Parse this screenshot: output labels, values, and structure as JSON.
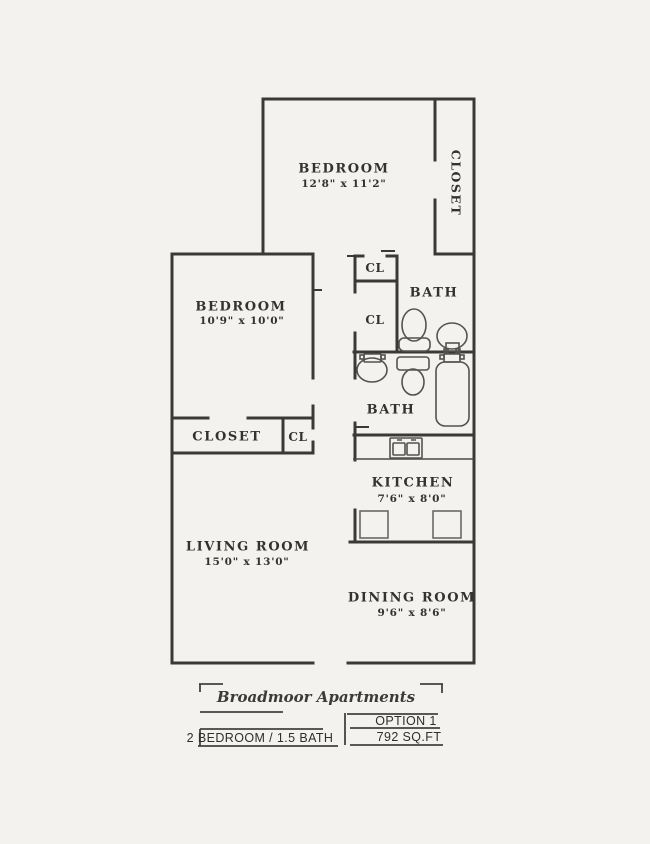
{
  "plan": {
    "bedroom_top": {
      "label": "BEDROOM",
      "dims": "12'8\" x 11'2\"",
      "closet": "CLOSET"
    },
    "bedroom_left": {
      "label": "BEDROOM",
      "dims": "10'9\" x 10'0\""
    },
    "upper_cl": "CL",
    "hall_cl": "CL",
    "bath_half": {
      "label": "BATH"
    },
    "bath_full": {
      "label": "BATH"
    },
    "closet_row": {
      "closet": "CLOSET",
      "cl": "CL"
    },
    "kitchen": {
      "label": "KITCHEN",
      "dims": "7'6\" x 8'0\""
    },
    "living": {
      "label": "LIVING ROOM",
      "dims": "15'0\" x 13'0\""
    },
    "dining": {
      "label": "DINING ROOM",
      "dims": "9'6\" x 8'6\""
    }
  },
  "title_block": {
    "name": "Broadmoor Apartments",
    "option": "OPTION 1",
    "unit": "2 BEDROOM / 1.5 BATH",
    "area": "792 SQ.FT"
  },
  "colors": {
    "paper": "#f3f2ef",
    "wall": "#3a3938",
    "text": "#34322f"
  }
}
